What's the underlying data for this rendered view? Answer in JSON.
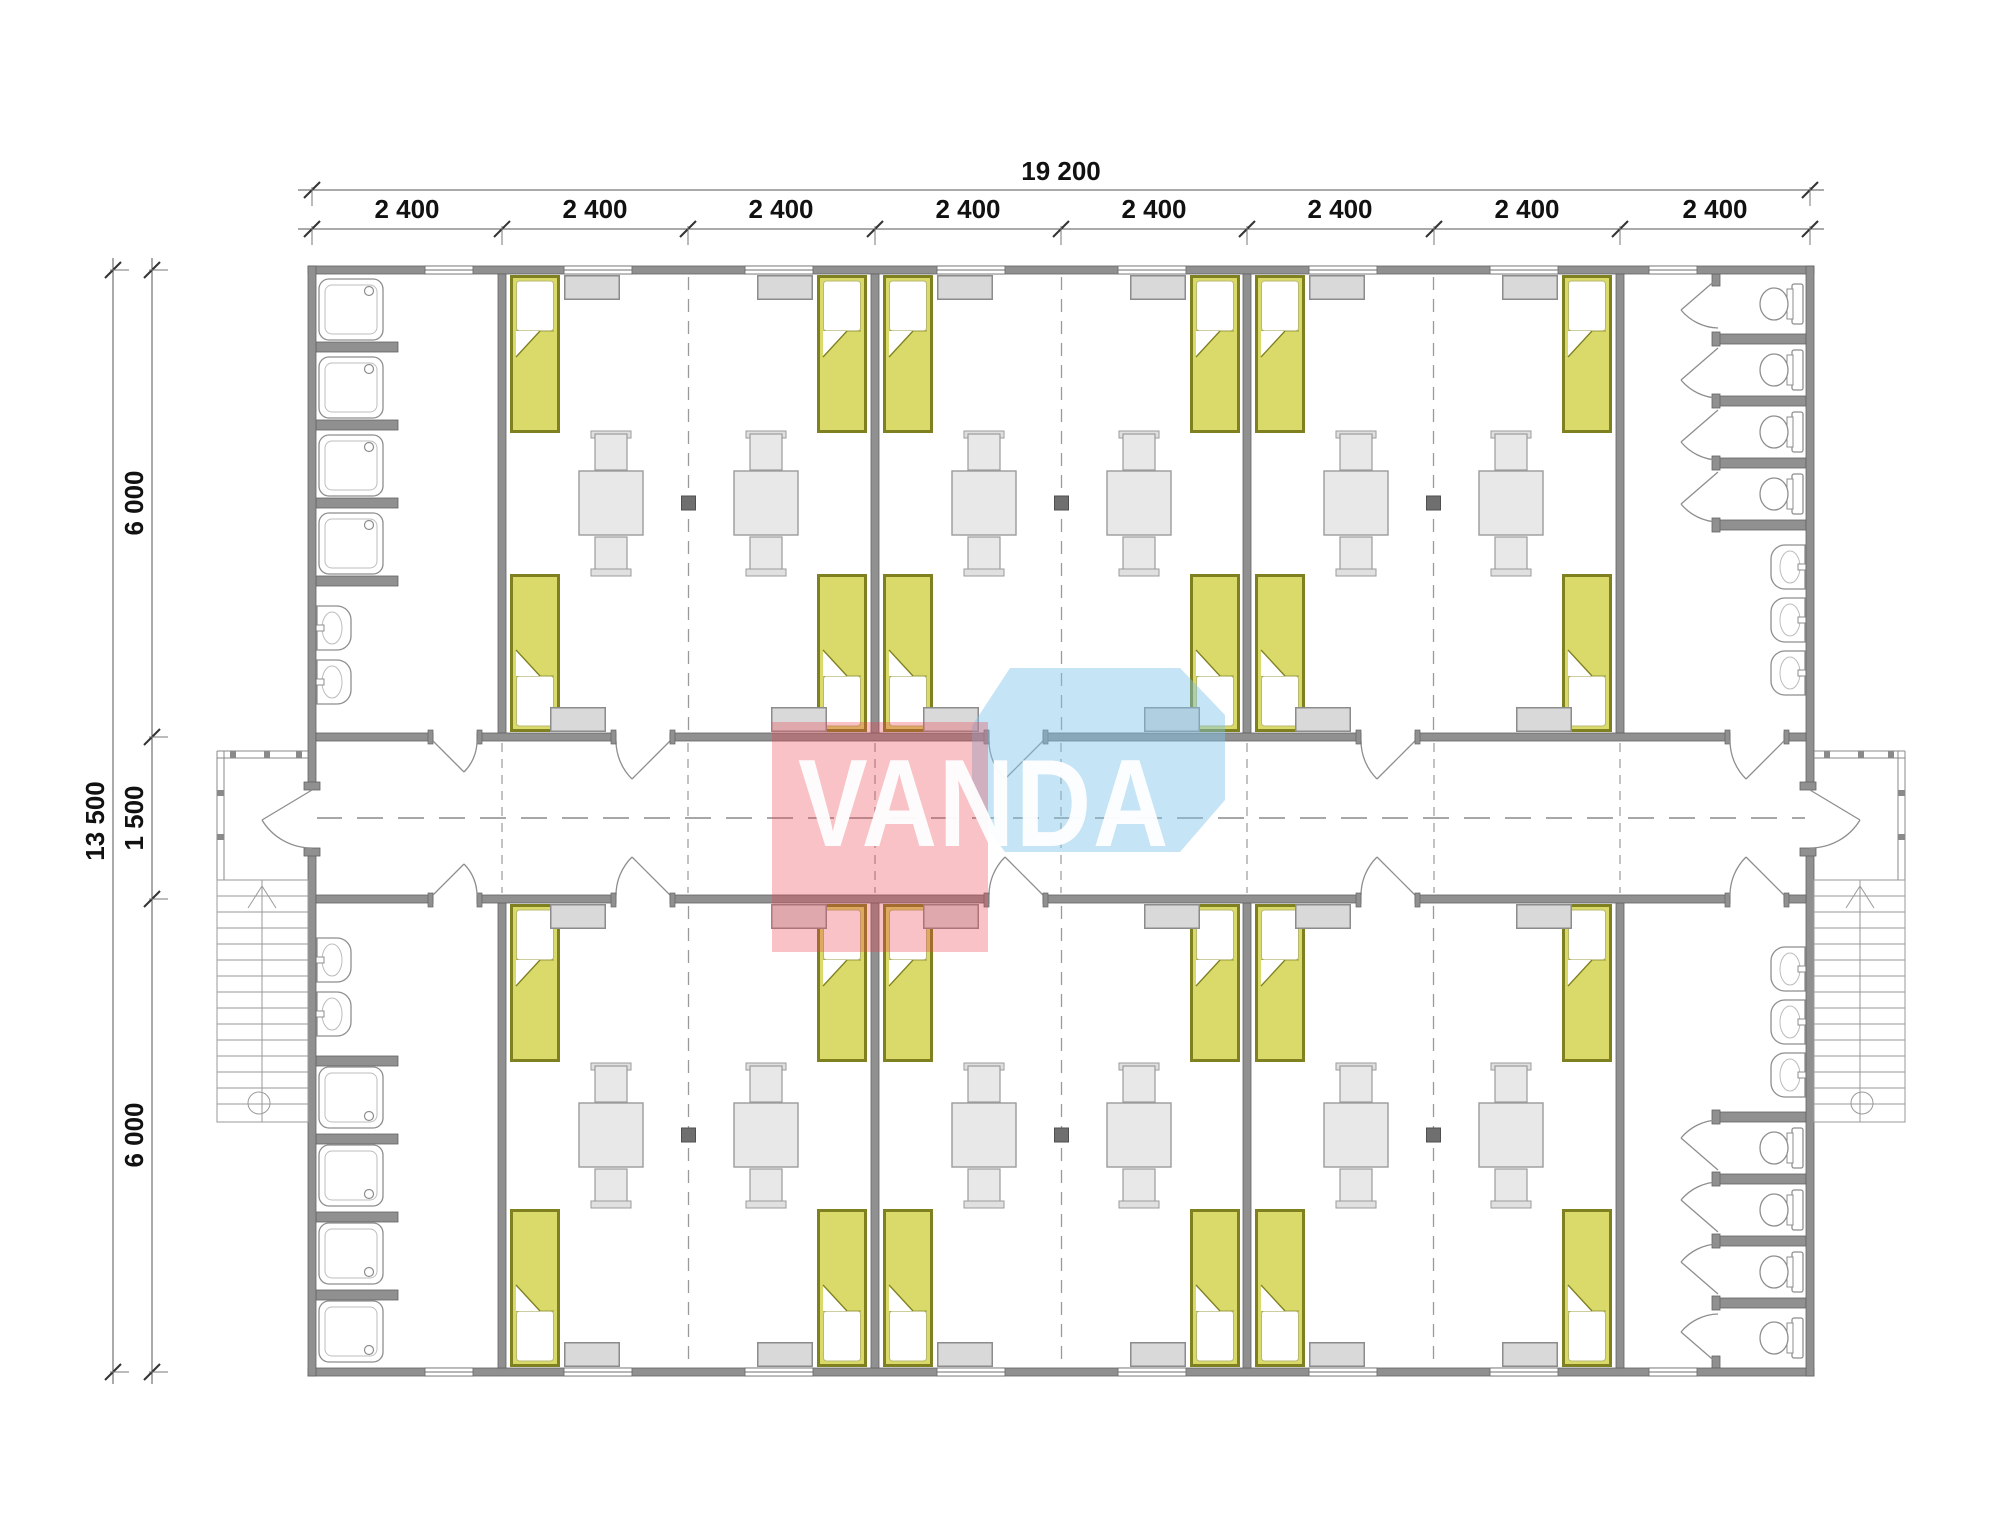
{
  "logo": {
    "text": "VANDA",
    "pink_color": "#e8404e",
    "blue_color": "#7fc4e8"
  },
  "dimensions": {
    "total_width_label": "19 200",
    "width_segment_labels": [
      "2 400",
      "2 400",
      "2 400",
      "2 400",
      "2 400",
      "2 400",
      "2 400",
      "2 400"
    ],
    "total_height_label": "13 500",
    "height_segment_labels": [
      "6 000",
      "1 500",
      "6 000"
    ]
  },
  "colors": {
    "wall": "#909090",
    "bed_fill": "#d9da69",
    "bed_border": "#7f801f",
    "wardrobe_fill": "#d9d9d9",
    "furniture_fill": "#e8e8e8",
    "fixture_stroke": "#8e8e8e",
    "column": "#6f6f6f",
    "dim_text": "#111111"
  }
}
